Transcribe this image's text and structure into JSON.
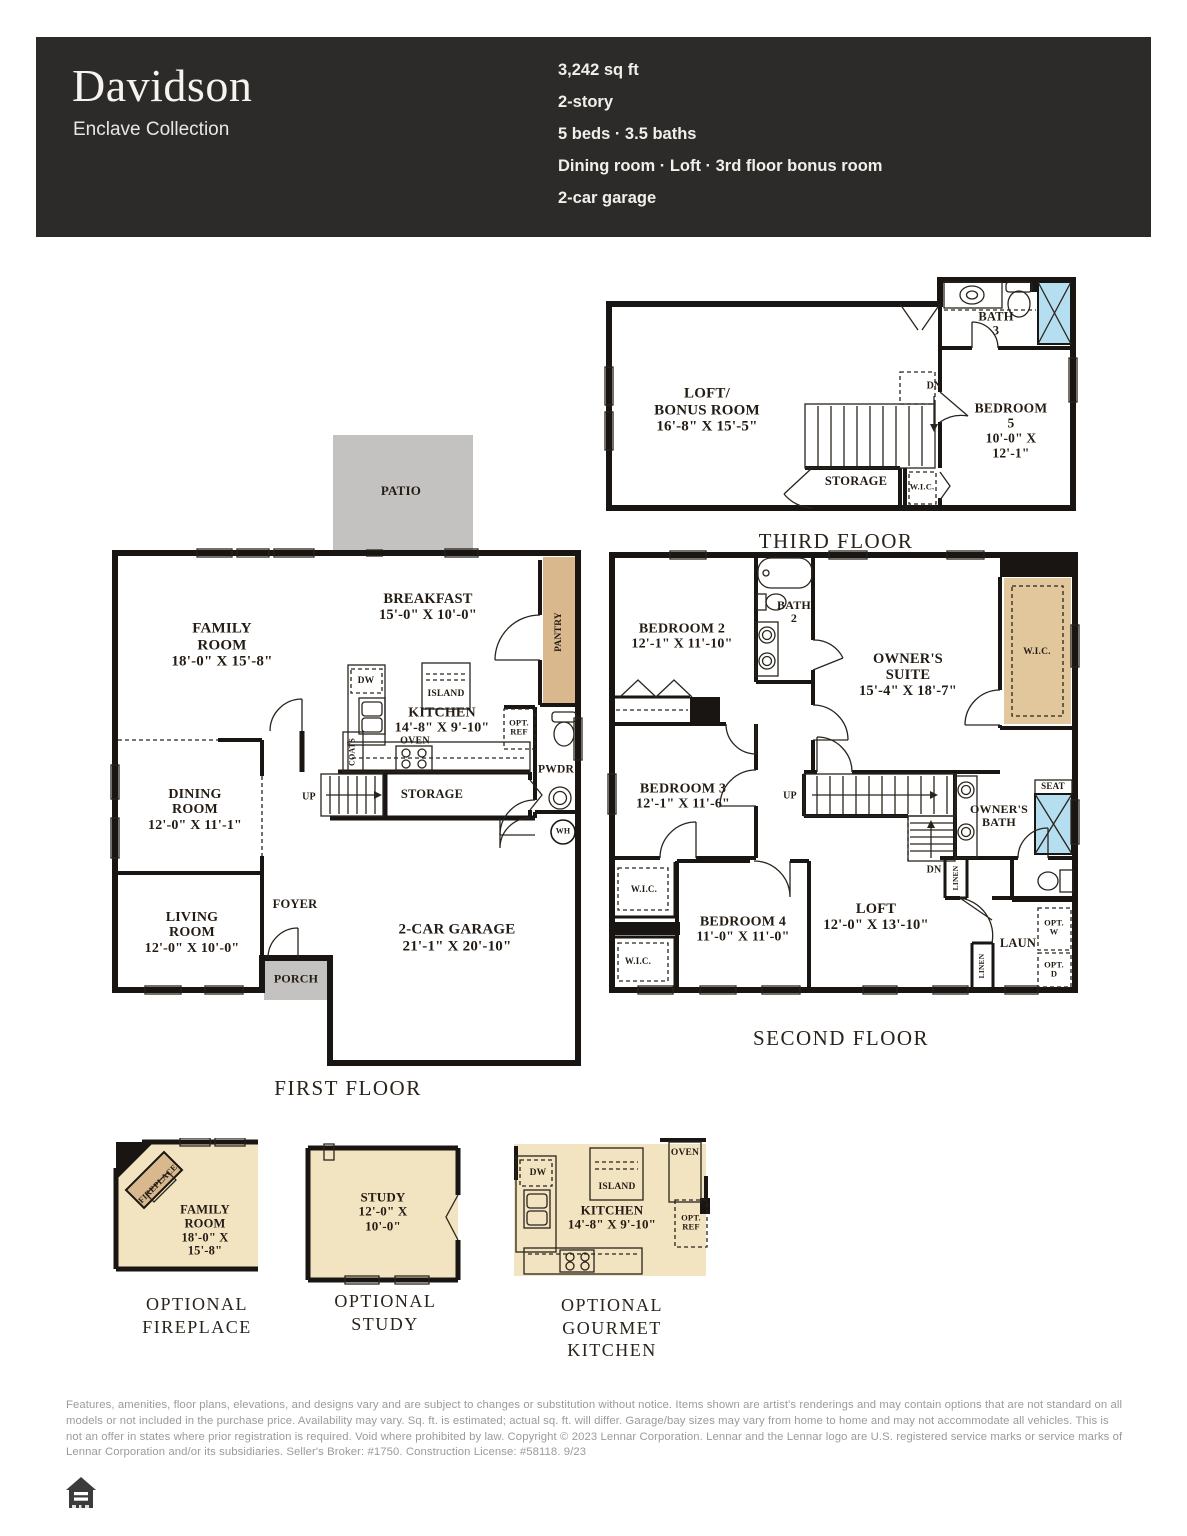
{
  "header": {
    "title": "Davidson",
    "collection": "Enclave Collection",
    "specs": [
      "3,242 sq ft",
      "2-story",
      "5 beds · 3.5 baths",
      "Dining room · Loft · 3rd floor bonus room",
      "2-car garage"
    ]
  },
  "floors": {
    "third": {
      "caption": "THIRD FLOOR",
      "labels": {
        "loft": "LOFT/\nBONUS ROOM\n16'-8\" X 15'-5\"",
        "bath": "BATH\n3",
        "bedroom5": "BEDROOM 5\n10'-0\" X 12'-1\"",
        "dn": "DN",
        "storage": "STORAGE",
        "wic": "W.I.C."
      }
    },
    "first": {
      "caption": "FIRST FLOOR",
      "labels": {
        "patio": "PATIO",
        "family": "FAMILY\nROOM\n18'-0\" X 15'-8\"",
        "breakfast": "BREAKFAST\n15'-0\" X 10'-0\"",
        "pantry": "PANTRY",
        "dw": "DW",
        "island": "ISLAND",
        "kitchen": "KITCHEN\n14'-8\" X 9'-10\"",
        "oven": "OVEN",
        "opt_ref": "OPT.\nREF",
        "coats": "COATS",
        "pwdr": "PWDR",
        "storage": "STORAGE",
        "up": "UP",
        "dining": "DINING\nROOM\n12'-0\" X 11'-1\"",
        "living": "LIVING\nROOM\n12'-0\" X 10'-0\"",
        "foyer": "FOYER",
        "porch": "PORCH",
        "garage": "2-CAR GARAGE\n21'-1\" X 20'-10\"",
        "wh": "WH"
      }
    },
    "second": {
      "caption": "SECOND FLOOR",
      "labels": {
        "bedroom2": "BEDROOM 2\n12'-1\" X 11'-10\"",
        "bath2": "BATH\n2",
        "owners_suite": "OWNER'S\nSUITE\n15'-4\" X 18'-7\"",
        "wic_owners": "W.I.C.",
        "bedroom3": "BEDROOM 3\n12'-1\" X 11'-6\"",
        "up": "UP",
        "dn": "DN",
        "owners_bath": "OWNER'S\nBATH",
        "seat": "SEAT",
        "linen_a": "LINEN",
        "linen_b": "LINEN",
        "wic_a": "W.I.C.",
        "wic_b": "W.I.C.",
        "bedroom4": "BEDROOM 4\n11'-0\" X 11'-0\"",
        "loft": "LOFT\n12'-0\" X 13'-10\"",
        "laun": "LAUN",
        "opt_w": "OPT.\nW",
        "opt_d": "OPT.\nD"
      }
    }
  },
  "options": {
    "fireplace": {
      "caption": "OPTIONAL\nFIREPLACE",
      "labels": {
        "fireplace": "FIREPLACE",
        "family": "FAMILY\nROOM\n18'-0\" X 15'-8\""
      }
    },
    "study": {
      "caption": "OPTIONAL STUDY",
      "labels": {
        "study": "STUDY\n12'-0\" X 10'-0\""
      }
    },
    "gourmet": {
      "caption": "OPTIONAL\nGOURMET KITCHEN",
      "labels": {
        "dw": "DW",
        "island": "ISLAND",
        "kitchen": "KITCHEN\n14'-8\" X 9'-10\"",
        "oven": "OVEN",
        "opt_ref": "OPT.\nREF"
      }
    }
  },
  "footer": {
    "disclaimer": "Features, amenities, floor plans, elevations, and designs vary and are subject to changes or substitution without notice. Items shown are artist's renderings and may contain options that are not standard on all models or not included in the purchase price. Availability may vary. Sq. ft. is estimated; actual sq. ft. will differ. Garage/bay sizes may vary from home to home and may not accommodate all vehicles. This is not an offer in states where prior registration is required. Void where prohibited by law. Copyright © 2023 Lennar Corporation. Lennar and the Lennar logo are U.S. registered service marks or service marks of Lennar Corporation and/or its subsidiaries. Seller's Broker: #1750. Construction License: #58118. 9/23",
    "equal_housing_icon": "equal-housing-opportunity-logo"
  },
  "colors": {
    "header_bg": "#2d2b29",
    "floor": "#f2e3c1",
    "cabinet": "#d8b88c",
    "water": "#b5dff0",
    "wall": "#191512",
    "patio": "#c4c2c0",
    "label": "#241c14",
    "disclaimer": "#9b9b9b"
  }
}
